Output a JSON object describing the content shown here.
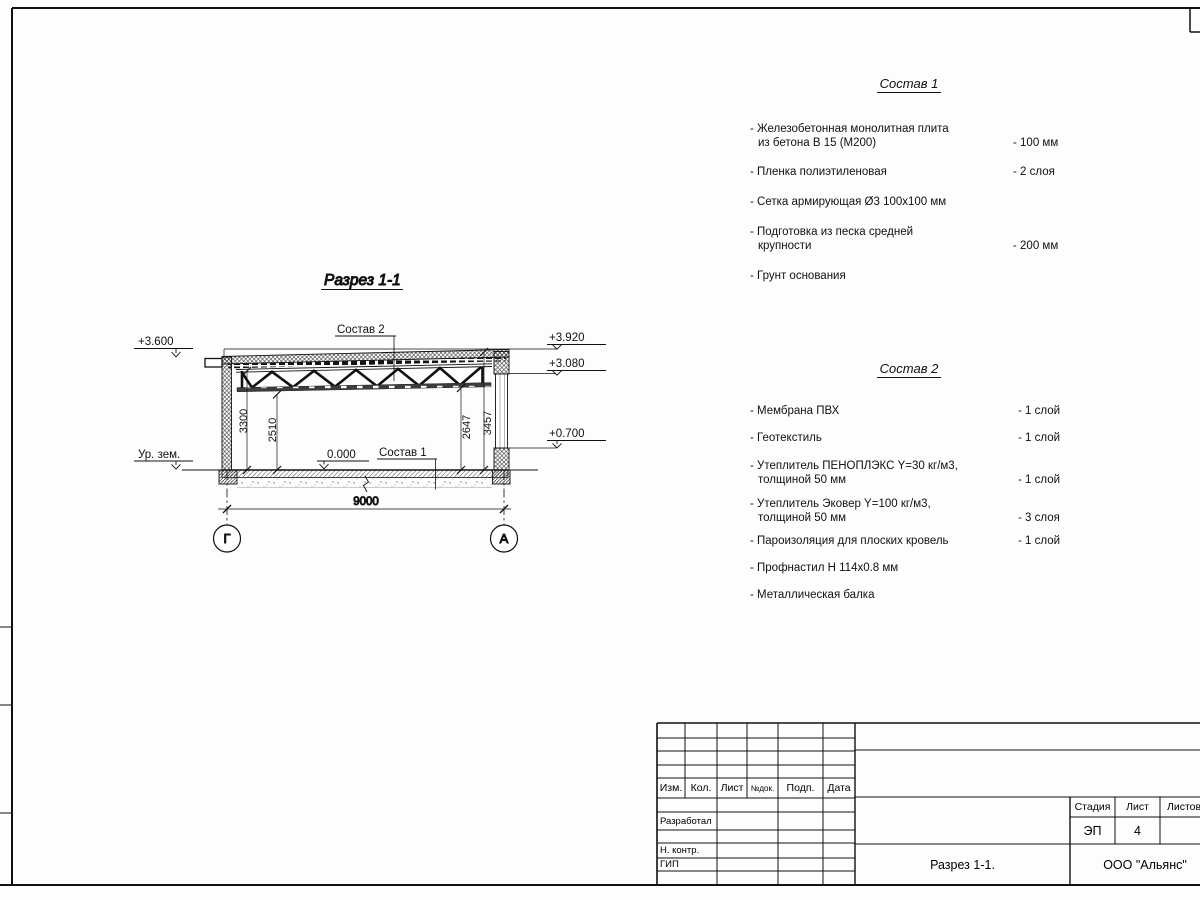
{
  "drawing": {
    "title": "Разрез 1-1",
    "elev_left_top": "+3.600",
    "ground_level": "Ур. зем.",
    "elev_right_top": "+3.920",
    "elev_right_mid": "+3.080",
    "elev_right_low": "+0.700",
    "zero_mark": "0.000",
    "ref_sostav1": "Состав 1",
    "ref_sostav2": "Состав 2",
    "dim_wall_left": "3300",
    "dim_clear_left": "2510",
    "dim_clear_right": "2647",
    "dim_wall_right": "3457",
    "dim_span": "9000",
    "axis_left": "Г",
    "axis_right": "А"
  },
  "sostav1": {
    "title": "Состав 1",
    "items": [
      {
        "line1": "- Железобетонная  монолитная плита",
        "line2": "из бетона В 15 (М200)",
        "value": "- 100 мм"
      },
      {
        "line1": "- Пленка полиэтиленовая",
        "value": "-  2 слоя"
      },
      {
        "line1": "- Сетка армирующая Ø3 100х100 мм",
        "value": ""
      },
      {
        "line1": "- Подготовка из песка средней",
        "line2": "крупности",
        "value": "- 200 мм"
      },
      {
        "line1": "- Грунт основания",
        "value": ""
      }
    ]
  },
  "sostav2": {
    "title": "Состав 2",
    "items": [
      {
        "line1": "- Мембрана ПВХ",
        "value": "- 1 слой"
      },
      {
        "line1": "- Геотекстиль",
        "value": "- 1 слой"
      },
      {
        "line1": "- Утеплитель ПЕНОПЛЭКС Y=30 кг/м3,",
        "line2": "толщиной 50 мм",
        "value": "- 1 слой"
      },
      {
        "line1": "- Утеплитель Эковер Y=100 кг/м3,",
        "line2": "толщиной 50 мм",
        "value": "- 3 слоя"
      },
      {
        "line1": "- Пароизоляция для плоских кровель",
        "value": "- 1 слой"
      },
      {
        "line1": "- Профнастил Н 114х0.8 мм",
        "value": ""
      },
      {
        "line1": "- Металлическая балка",
        "value": ""
      }
    ]
  },
  "titleblock": {
    "rev_headers": [
      "Изм.",
      "Кол.",
      "Лист",
      "№док.",
      "Подп.",
      "Дата"
    ],
    "roles": [
      "Разработал",
      "Н. контр.",
      "ГИП"
    ],
    "stage_header": "Стадия",
    "sheet_header": "Лист",
    "sheets_header": "Листов",
    "stage": "ЭП",
    "sheet": "4",
    "doc_title": "Разрез 1-1.",
    "company": "ООО \"Альянс\""
  }
}
